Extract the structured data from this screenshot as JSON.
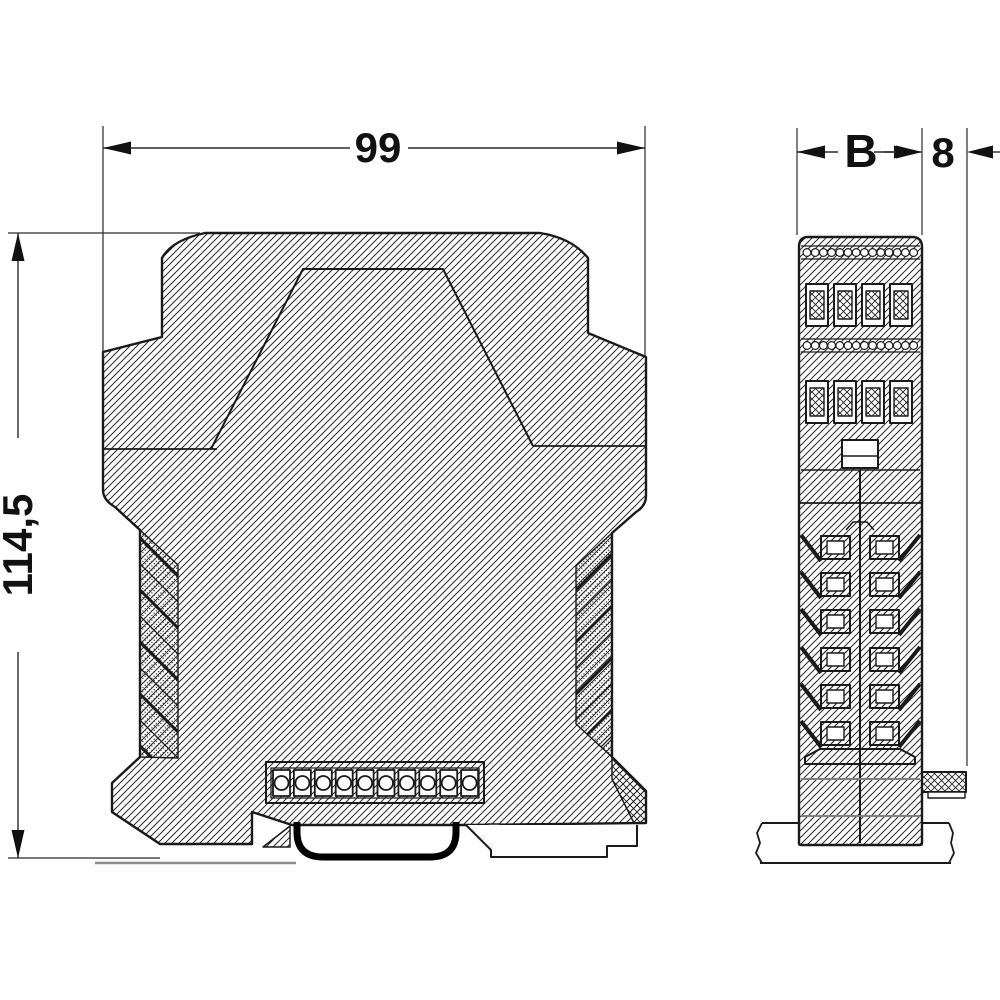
{
  "dimensions": {
    "overall_width": "99",
    "overall_height": "114,5",
    "module_width": "B",
    "latch_depth": "8"
  },
  "colors": {
    "line": "#1a1a1a",
    "dim_line": "#2a2a2a",
    "gray_line": "#8f8f8f",
    "background": "#ffffff"
  }
}
